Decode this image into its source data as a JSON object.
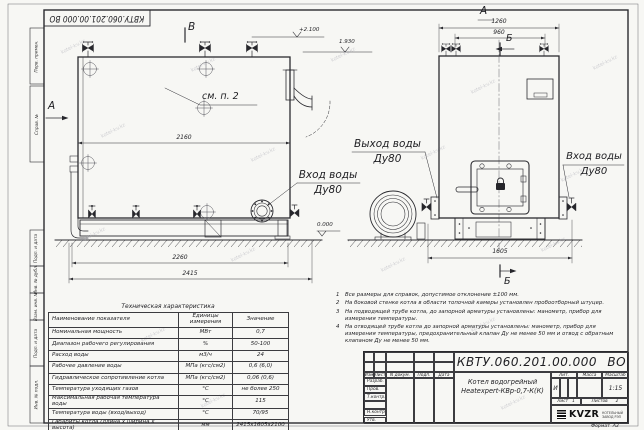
{
  "sheet": {
    "doc_number": "КВТУ.060.201.00.000 ВО",
    "watermark": "kotel-kv.kz"
  },
  "margin_stamps": {
    "s1": "Перв. примен.",
    "s2": "Справ. №",
    "s3": "Подп. и дата",
    "s4": "Инв. № дубл.",
    "s5": "Взам. инв. №",
    "s6": "Подп. и дата",
    "s7": "Инв. № подл."
  },
  "drawing": {
    "view_b_top": "В",
    "view_a_side": "А",
    "view_a_front": "А",
    "section_b_top": "Б",
    "section_b_bottom": "Б",
    "callout_see_item2": "см. п. 2",
    "dims": {
      "d2160": "2160",
      "d2260": "2260",
      "d2415": "2415",
      "d1260": "1260",
      "d960": "960",
      "d1605": "1605"
    },
    "elevations": {
      "top": "+2.100",
      "mid": "1.930",
      "zero": "0.000"
    },
    "labels": {
      "outlet": "Выход воды",
      "outlet_dn": "Ду80",
      "inlet_side": "Вход воды",
      "inlet_side_dn": "Ду80",
      "inlet_front": "Вход воды",
      "inlet_front_dn": "Ду80"
    }
  },
  "tech_table": {
    "title": "Техническая характеристика",
    "col_name": "Наименование показателя",
    "col_unit": "Единицы измерения",
    "col_value": "Значение",
    "rows": [
      {
        "name": "Номинальная мощность",
        "unit": "МВт",
        "value": "0,7"
      },
      {
        "name": "Диапазон рабочего регулирования",
        "unit": "%",
        "value": "50-100"
      },
      {
        "name": "Расход воды",
        "unit": "м3/ч",
        "value": "24"
      },
      {
        "name": "Рабочее давление воды",
        "unit": "МПа (кгс/см2)",
        "value": "0,6 (6,0)"
      },
      {
        "name": "Гидравлическое сопротивление котла",
        "unit": "МПа (кгс/см2)",
        "value": "0,06 (0,6)"
      },
      {
        "name": "Температура уходящих газов",
        "unit": "°С",
        "value": "не более 250"
      },
      {
        "name": "Максимальная рабочая температура воды",
        "unit": "°С",
        "value": "115"
      },
      {
        "name": "Температура воды (вход/выход)",
        "unit": "°С",
        "value": "70/95"
      },
      {
        "name": "Габариты котла (длина х ширина х высота)",
        "unit": "мм",
        "value": "2415х1605х2100"
      }
    ]
  },
  "notes": [
    {
      "num": "1",
      "text": "Все размеры для справок, допустимое отклонение ±100 мм."
    },
    {
      "num": "2",
      "text": "На боковой стенке котла в области топочной камеры установлен пробоотборный штуцер."
    },
    {
      "num": "3",
      "text": "На  подводящей трубе котла, до запорной арматуры установлены: манометр, прибор для измерения температуры."
    },
    {
      "num": "4",
      "text": "На отводящей трубе котла до запорной арматуры установлены: манометр, прибор для измерения температуры, предохранительный клапан Ду не менее 50 мм и отвод с обратным клапаном Ду не менее 50 мм."
    }
  ],
  "title_block": {
    "doc_number": "КВТУ.060.201.00.000 ВО",
    "product_line1": "Котел водогрейный",
    "product_line2": "Heatexpert-КВр-0,7-К(К)",
    "hdr_izm": "Изм",
    "hdr_list": "Лист",
    "hdr_ndoc": "N докум.",
    "hdr_podp": "Подп.",
    "hdr_data": "Дата",
    "row_razrab": "Разраб.",
    "row_prov": "Пров.",
    "row_tkontr": "Т.контр.",
    "row_nkontr": "Н.контр.",
    "row_utv": "Утв.",
    "lit_label": "Лит.",
    "mass_label": "Масса",
    "scale_label": "Масштаб",
    "lit_value": "И",
    "scale_value": "1:15",
    "sheet_label": "Лист",
    "sheet_value": "1",
    "sheets_label": "Листов",
    "sheets_value": "2",
    "logo": "KVZR",
    "logo_sub1": "КОТЕЛЬНЫЙ",
    "logo_sub2": "ЗАВОД РЭП",
    "format_label": "Формат",
    "format_value": "А3"
  }
}
